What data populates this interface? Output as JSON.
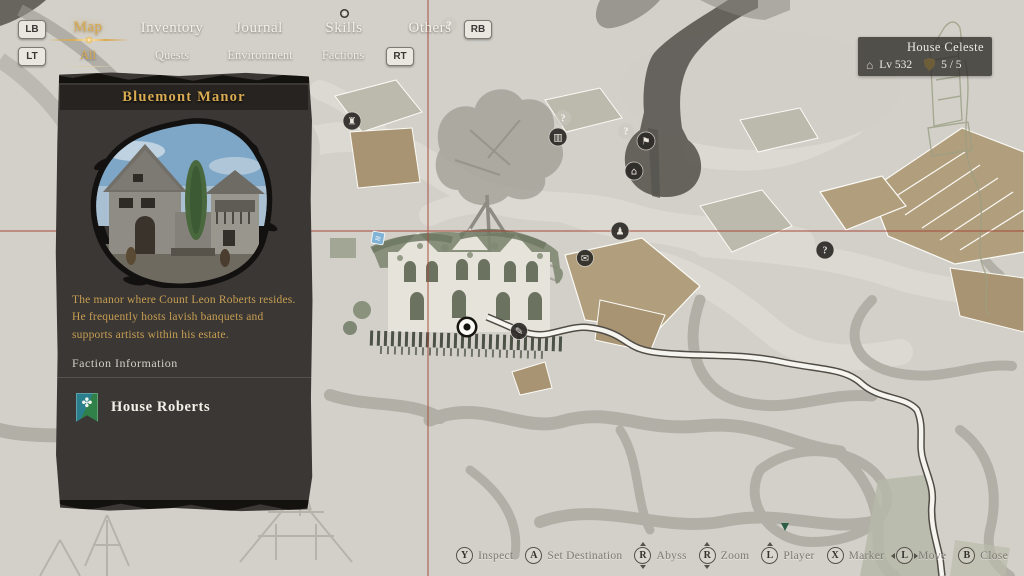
{
  "nav": {
    "shoulder_keys": {
      "lb": "LB",
      "rb": "RB",
      "lt": "LT",
      "rt": "RT"
    },
    "tabs": [
      {
        "label": "Map",
        "active": true
      },
      {
        "label": "Inventory",
        "active": false
      },
      {
        "label": "Journal",
        "active": false
      },
      {
        "label": "Skills",
        "active": false
      },
      {
        "label": "Others",
        "active": false
      }
    ],
    "subtabs": [
      {
        "label": "All",
        "active": true
      },
      {
        "label": "Quests",
        "active": false
      },
      {
        "label": "Environment",
        "active": false
      },
      {
        "label": "Factions",
        "active": false
      }
    ]
  },
  "location_badge": {
    "name": "House Celeste",
    "level": "Lv 532",
    "count": "5 / 5",
    "icons": [
      "house-icon",
      "shield-icon"
    ],
    "house_glyph": "⌂"
  },
  "panel": {
    "title": "Bluemont Manor",
    "description": "The manor where Count Leon Roberts resides. He frequently hosts lavish banquets and supports artists within his estate.",
    "faction_section": "Faction Information",
    "faction": {
      "name": "House Roberts",
      "banner_icon": "house-roberts-banner"
    }
  },
  "map": {
    "crosshair_color": "#a84a3a",
    "pois": [
      {
        "glyph": "♜",
        "kind": "landmark"
      },
      {
        "glyph": "▥",
        "kind": "landmark"
      },
      {
        "glyph": "⚑",
        "kind": "landmark"
      },
      {
        "glyph": "⌂",
        "kind": "landmark"
      },
      {
        "glyph": "♟",
        "kind": "npc"
      },
      {
        "glyph": "✉",
        "kind": "quest"
      },
      {
        "glyph": "✎",
        "kind": "landmark"
      },
      {
        "glyph": "?",
        "kind": "unknown"
      },
      {
        "glyph": "?",
        "kind": "unknown-faint"
      },
      {
        "glyph": "?",
        "kind": "unknown-faint"
      },
      {
        "glyph": "?",
        "kind": "unknown-faint"
      },
      {
        "glyph": "≋",
        "kind": "fast-travel"
      }
    ]
  },
  "hints": [
    {
      "button": "Y",
      "label": "Inspect",
      "kind": "face"
    },
    {
      "button": "A",
      "label": "Set Destination",
      "kind": "face"
    },
    {
      "button": "R",
      "label": "Abyss",
      "kind": "stick-ud"
    },
    {
      "button": "R",
      "label": "Zoom",
      "kind": "stick-ud"
    },
    {
      "button": "L",
      "label": "Player",
      "kind": "stick-u"
    },
    {
      "button": "X",
      "label": "Marker",
      "kind": "face"
    },
    {
      "button": "L",
      "label": "Move",
      "kind": "stick-lr"
    },
    {
      "button": "B",
      "label": "Close",
      "kind": "face"
    }
  ],
  "colors": {
    "accent_gold": "#d9ab52",
    "panel_bg": "#3a3734",
    "map_bg": "#d6d3cc",
    "crosshair_red": "#a84a3a",
    "poi_bg": "#2e2c29",
    "road_white": "#f6f4ef",
    "banner_green": "#2f8049",
    "banner_teal": "#2a7f8c"
  }
}
